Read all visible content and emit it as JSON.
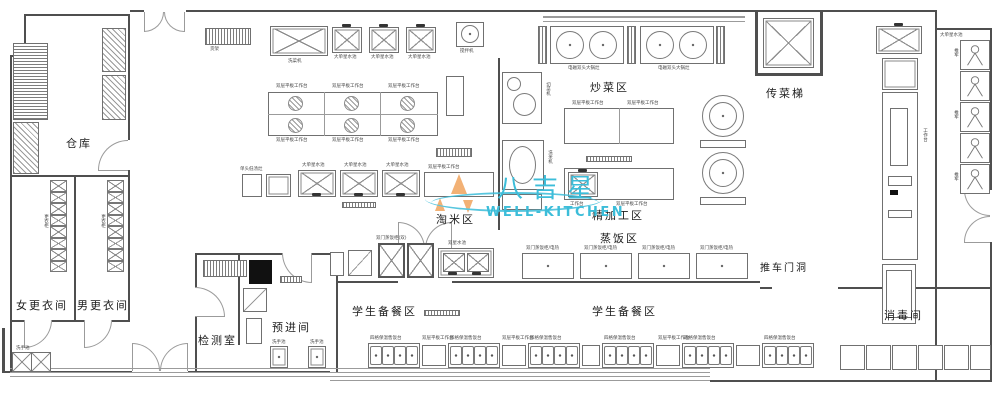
{
  "watermark": {
    "brand_cn": "八吉星",
    "brand_en": "WELL-KITCHEN",
    "accent_cyan": "#3cbdd9",
    "accent_orange": "#f0a45e"
  },
  "rooms": {
    "warehouse": "仓库",
    "women_changing": "女更衣间",
    "men_changing": "男更衣间",
    "testing_room": "检测室",
    "pre_entry_room": "预进间",
    "rice_washing_area": "淘米区",
    "stir_fry_area": "炒菜区",
    "fine_processing_area": "精加工区",
    "steam_rice_area": "蒸饭区",
    "food_elevator": "传菜梯",
    "cart_doorway": "推车门洞",
    "disinfection_room": "消毒间",
    "student_serving_left": "学生备餐区",
    "student_serving_right": "学生备餐区"
  },
  "equipment": {
    "veg_washer": "洗菜机",
    "big_single_sink": "大单星水池",
    "double_sink": "双星水池",
    "double_layer_table": "双层平板工作台",
    "work_table": "工作台",
    "mixer": "搅拌机",
    "induction_wok": "电磁双头大锅灶",
    "steam_cabinet_elec": "双门蒸饭柜/电热",
    "steam_cabinet_double": "双门蒸饭柜(双)",
    "serving_counter": "四格保温售饭台",
    "locker": "更衣柜",
    "hand_sink": "洗手池",
    "shelf": "货架",
    "veg_cutter": "切菜机",
    "rice_washer": "洗米机",
    "soup_stove": "单头低汤灶",
    "trolley": "推车"
  }
}
